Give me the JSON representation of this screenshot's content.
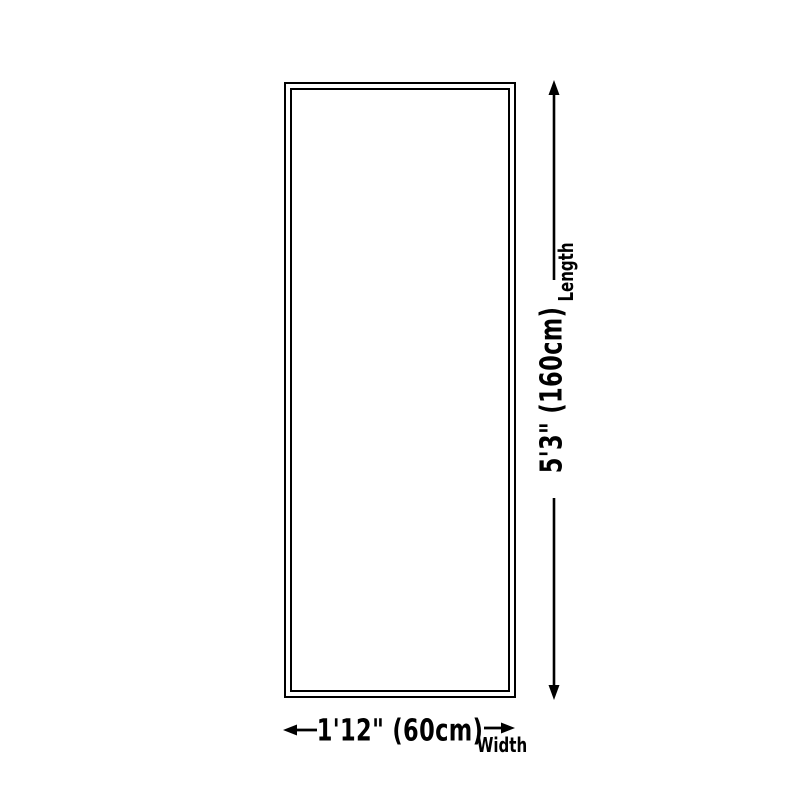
{
  "diagram": {
    "length": {
      "label": "Length",
      "value": "5'3\" (160cm)"
    },
    "width": {
      "label": "Width",
      "value": "1'12\" (60cm)"
    }
  },
  "colors": {
    "ink": "#000000",
    "background": "#ffffff"
  }
}
